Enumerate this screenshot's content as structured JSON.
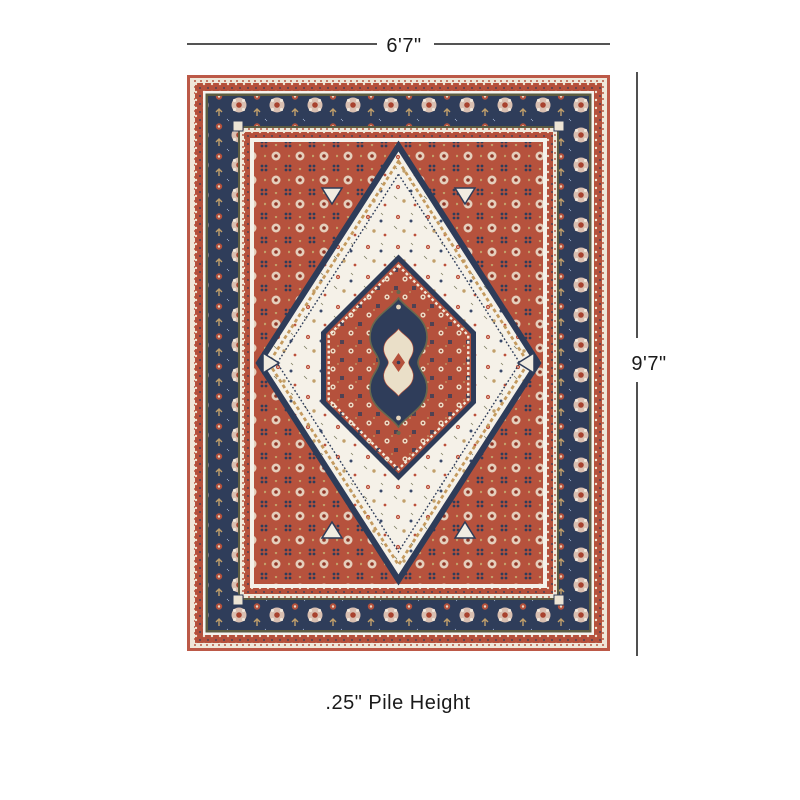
{
  "diagram": {
    "width_label": "6'7\"",
    "height_label": "9'7\"",
    "pile_height_label": ".25\" Pile Height",
    "line_color": "#3c3c3c",
    "text_color": "#1a1a1a"
  },
  "rug": {
    "colors": {
      "navy": "#2f3d5a",
      "rust_edge": "#bc5947",
      "red": "#b5513c",
      "cream_field": "#f5f1e8",
      "olive": "#5c5c41",
      "tan": "#c2a06a",
      "blush": "#d9bfb1",
      "white_band": "#f4f2ed"
    }
  }
}
